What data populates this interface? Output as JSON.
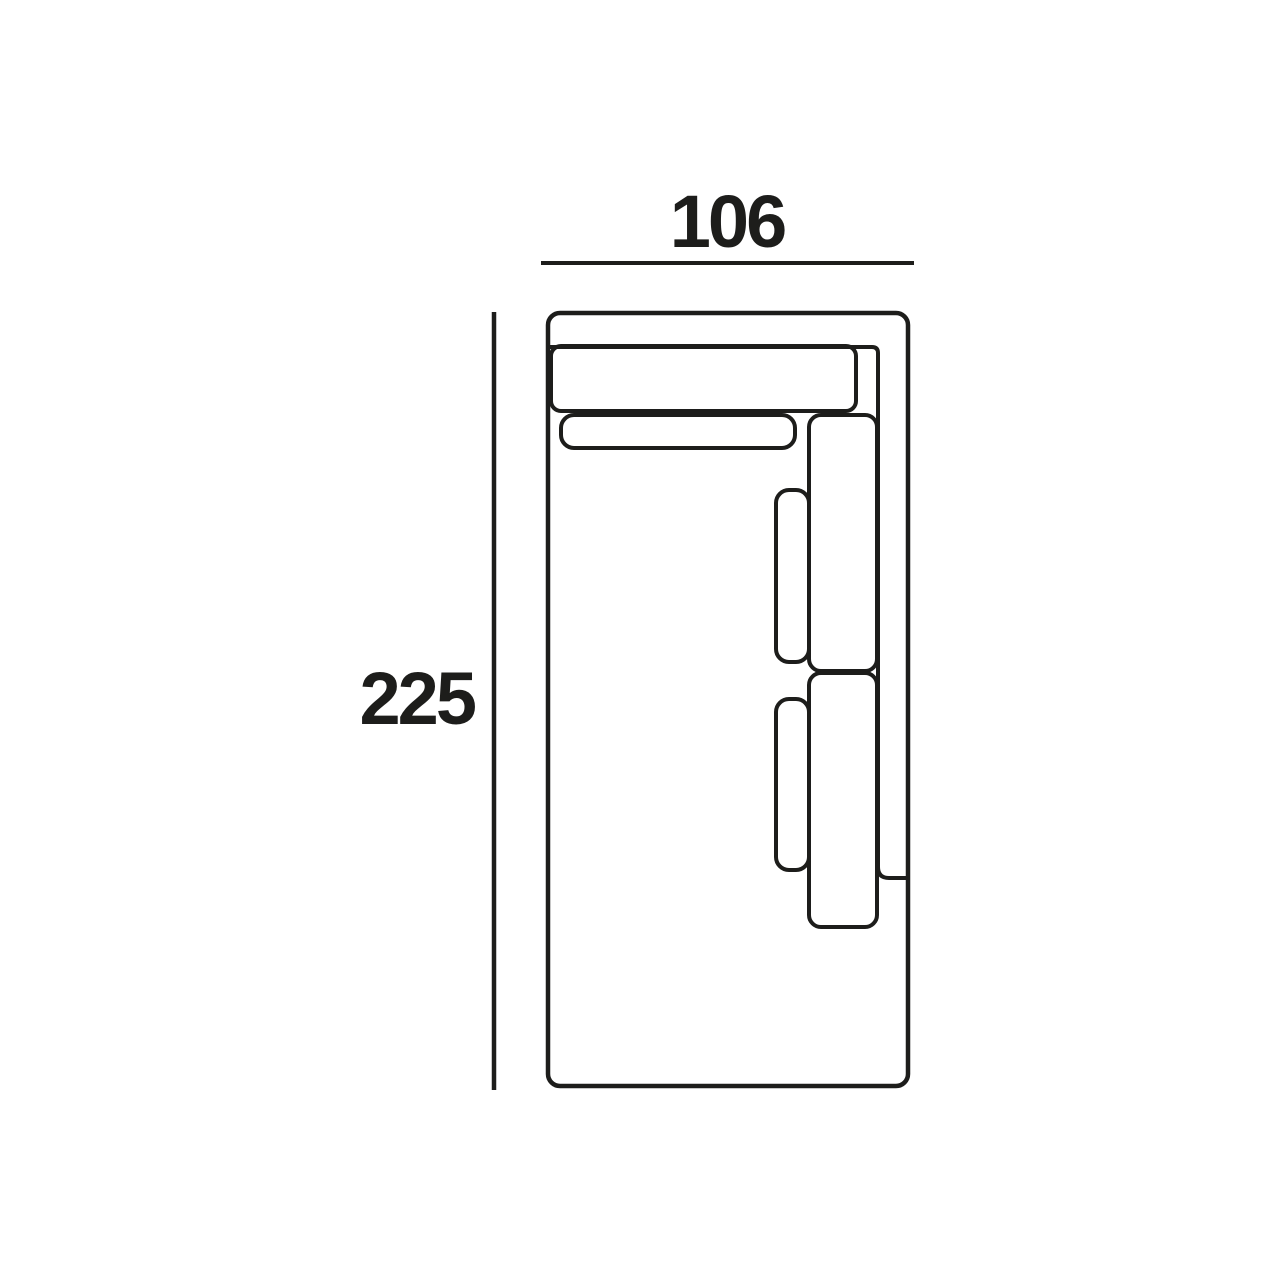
{
  "canvas": {
    "background_color": "#ffffff",
    "line_color": "#1d1d1b"
  },
  "drawing": {
    "subject": "sofa-module-top-view",
    "dimensions": {
      "width_label": "106",
      "depth_label": "225"
    }
  }
}
